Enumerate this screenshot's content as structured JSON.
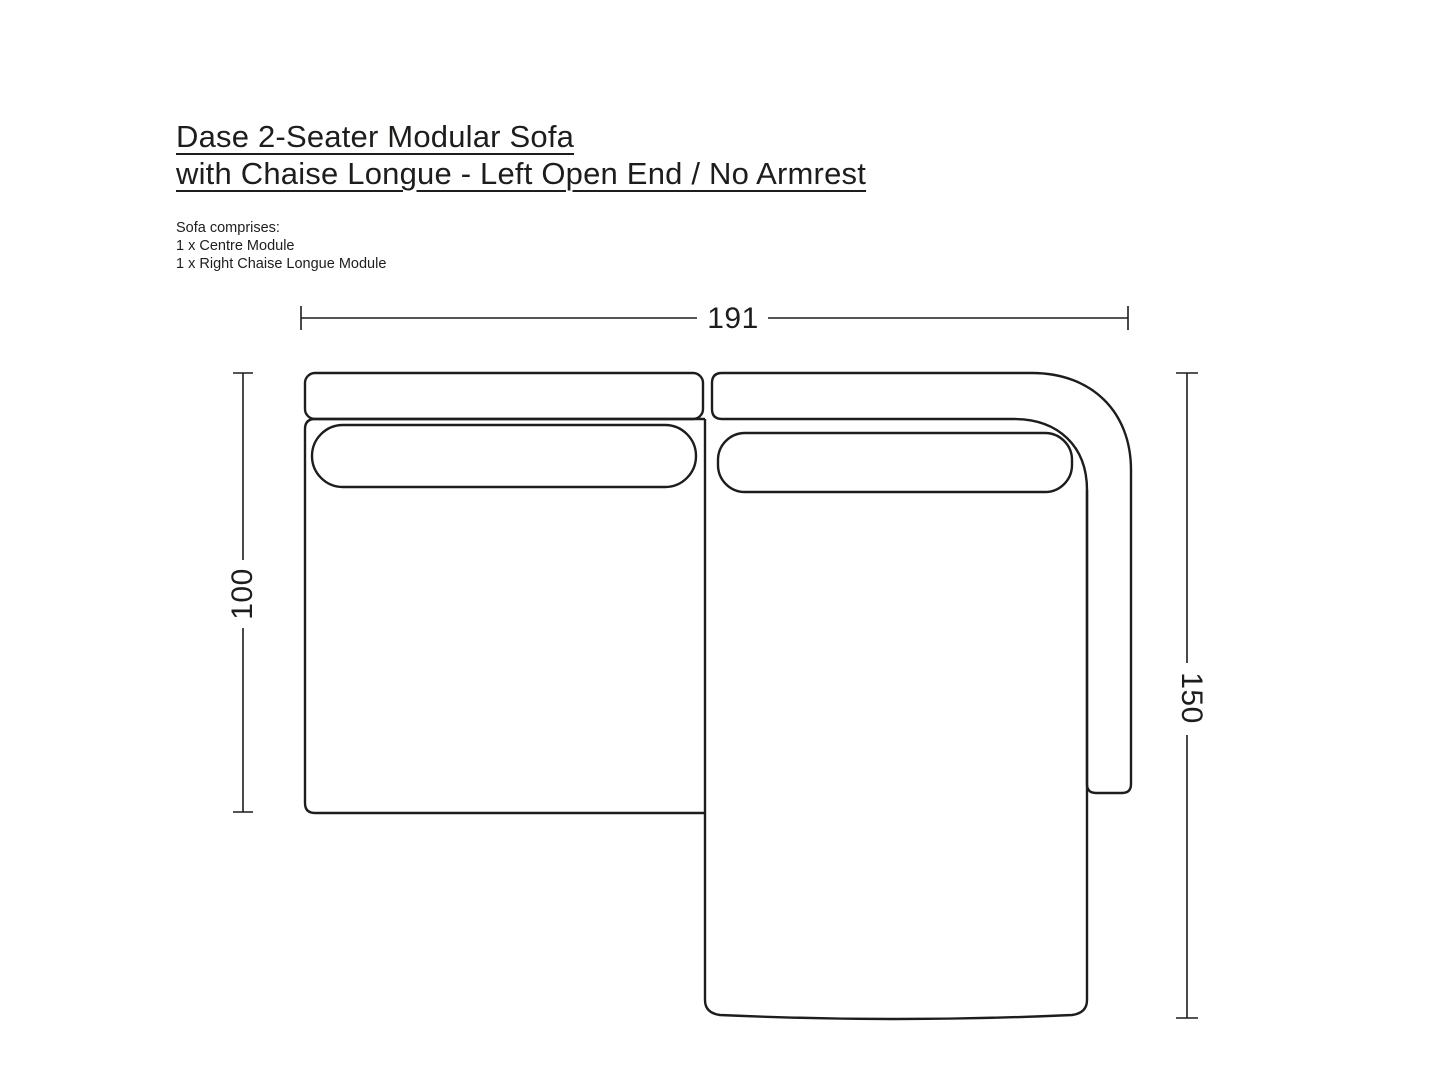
{
  "colors": {
    "background": "#ffffff",
    "ink": "#1d1d1b"
  },
  "header": {
    "title_line1": "Dase 2-Seater Modular Sofa",
    "title_line2": "with Chaise Longue - Left Open End / No Armrest",
    "comprises_heading": "Sofa comprises:",
    "comprises_items": [
      "1 x Centre Module",
      "1 x Right Chaise Longue Module"
    ]
  },
  "diagram": {
    "view": "top-view line drawing of modular sofa",
    "dimensions": {
      "overall_width": "191",
      "left_depth": "100",
      "right_depth": "150"
    }
  }
}
